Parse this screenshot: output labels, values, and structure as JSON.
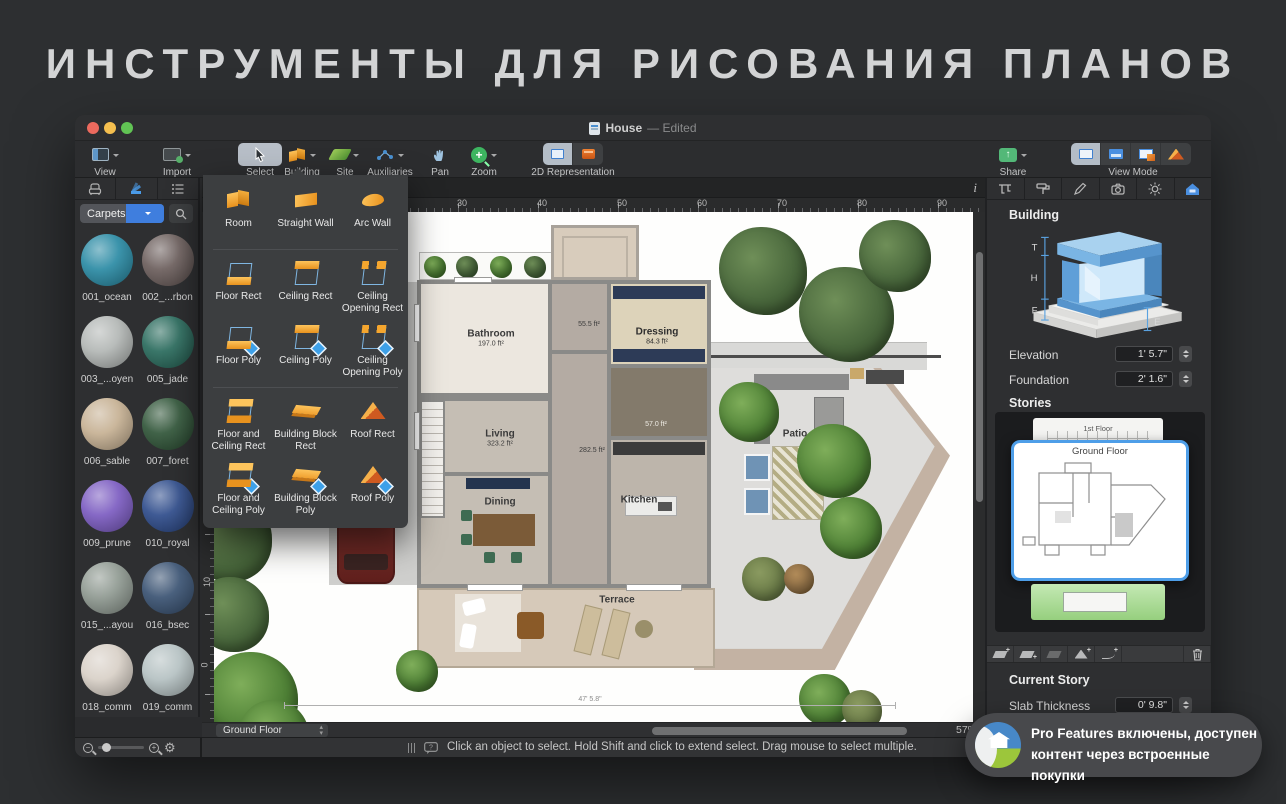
{
  "page": {
    "title": "ИНСТРУМЕНТЫ ДЛЯ РИСОВАНИЯ ПЛАНОВ"
  },
  "window": {
    "title": "House",
    "edited_suffix": "— Edited"
  },
  "toolbar": {
    "view": "View",
    "import": "Import",
    "select": "Select",
    "building": "Building",
    "site": "Site",
    "auxiliaries": "Auxiliaries",
    "pan": "Pan",
    "zoom": "Zoom",
    "representation": "2D Representation",
    "share": "Share",
    "view_mode": "View Mode"
  },
  "building_menu": {
    "items": [
      {
        "label": "Room",
        "icon": "room-icon"
      },
      {
        "label": "Straight Wall",
        "icon": "straight-wall-icon"
      },
      {
        "label": "Arc Wall",
        "icon": "arc-wall-icon"
      },
      {
        "label": "Floor Rect",
        "icon": "floor-rect-icon"
      },
      {
        "label": "Ceiling Rect",
        "icon": "ceiling-rect-icon"
      },
      {
        "label": "Ceiling Opening Rect",
        "icon": "ceiling-opening-rect-icon"
      },
      {
        "label": "Floor Poly",
        "icon": "floor-poly-icon"
      },
      {
        "label": "Ceiling Poly",
        "icon": "ceiling-poly-icon"
      },
      {
        "label": "Ceiling Opening Poly",
        "icon": "ceiling-opening-poly-icon"
      },
      {
        "label": "Floor and Ceiling Rect",
        "icon": "floor-and-ceiling-rect-icon"
      },
      {
        "label": "Building Block Rect",
        "icon": "building-block-rect-icon"
      },
      {
        "label": "Roof Rect",
        "icon": "roof-rect-icon"
      },
      {
        "label": "Floor and Ceiling Poly",
        "icon": "floor-and-ceiling-poly-icon"
      },
      {
        "label": "Building Block Poly",
        "icon": "building-block-poly-icon"
      },
      {
        "label": "Roof Poly",
        "icon": "roof-poly-icon"
      }
    ]
  },
  "sidebar": {
    "category": "Carpets",
    "swatches": [
      {
        "label": "001_ocean",
        "color": "#2f8da6"
      },
      {
        "label": "002_...rbon",
        "color": "#6f6260"
      },
      {
        "label": "003_...oyen",
        "color": "#b4b8b6"
      },
      {
        "label": "005_jade",
        "color": "#2e6e60"
      },
      {
        "label": "006_sable",
        "color": "#c7b295"
      },
      {
        "label": "007_foret",
        "color": "#35593d"
      },
      {
        "label": "009_prune",
        "color": "#7e5fc2"
      },
      {
        "label": "010_royal",
        "color": "#33508e"
      },
      {
        "label": "015_...ayou",
        "color": "#919b93"
      },
      {
        "label": "016_bsec",
        "color": "#3e5675"
      },
      {
        "label": "018_comm",
        "color": "#d9d1c8"
      },
      {
        "label": "019_comm",
        "color": "#b6c2c3"
      }
    ]
  },
  "canvas": {
    "hruler": [
      "30",
      "40",
      "50",
      "60",
      "70",
      "80",
      "90"
    ],
    "vruler": [
      "10",
      "0"
    ],
    "info_icon": "i",
    "story_popup": "Ground Floor",
    "zoom_percent": "57%",
    "dimension": "47' 5.8\""
  },
  "plan": {
    "rooms": {
      "bathroom": {
        "name": "Bathroom",
        "area": "197.0 ft²"
      },
      "hall": {
        "area": "55.5 ft²"
      },
      "dressing": {
        "name": "Dressing",
        "area": "84.3 ft²"
      },
      "living": {
        "name": "Living",
        "area": "323.2 ft²"
      },
      "corridor": {
        "area": "282.5 ft²"
      },
      "closet": {
        "area": "57.0 ft²"
      },
      "dining": {
        "name": "Dining"
      },
      "kitchen": {
        "name": "Kitchen"
      },
      "terrace": {
        "name": "Terrace"
      },
      "patio": {
        "name": "Patio"
      }
    }
  },
  "inspector": {
    "building_title": "Building",
    "labels": {
      "t": "T",
      "h": "H",
      "f": "F",
      "e": "E"
    },
    "elevation_label": "Elevation",
    "elevation_value": "1' 5.7\"",
    "foundation_label": "Foundation",
    "foundation_value": "2' 1.6\"",
    "stories_title": "Stories",
    "first_floor": "1st Floor",
    "ground_floor": "Ground Floor",
    "current_story_title": "Current Story",
    "slab_label": "Slab Thickness",
    "slab_value": "0' 9.8\""
  },
  "statusbar": {
    "text": "Click an object to select. Hold Shift and click to extend select. Drag mouse to select multiple."
  },
  "toast": {
    "line1": "Pro Features включены, доступен",
    "line2": "контент через встроенные покупки"
  },
  "colors": {
    "accent_blue": "#4a9be8",
    "tool_orange": "#f5a328",
    "select_gray": "#b9c0c8",
    "story_green": "#a9d895"
  }
}
